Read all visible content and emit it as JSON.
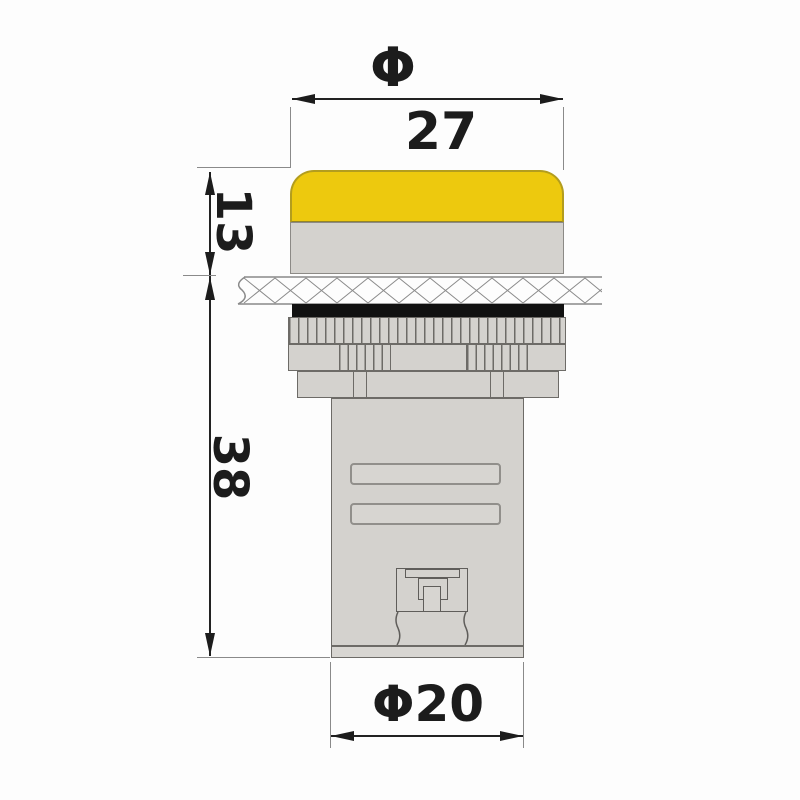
{
  "title": "panel indicator lamp dimension drawing",
  "dimensions": {
    "diameter_symbol": "Φ",
    "cap_diameter": "27",
    "cap_height": "13",
    "body_depth": "38",
    "thread_diameter": "Φ20"
  },
  "colors": {
    "lens": "#edc90e",
    "lens_border": "#b39d1e",
    "metal": "#d4d2ce",
    "outline": "#6d6b67",
    "gasket": "#111111",
    "dimension_line": "#1c1c1c",
    "background": "#fdfdfd"
  }
}
